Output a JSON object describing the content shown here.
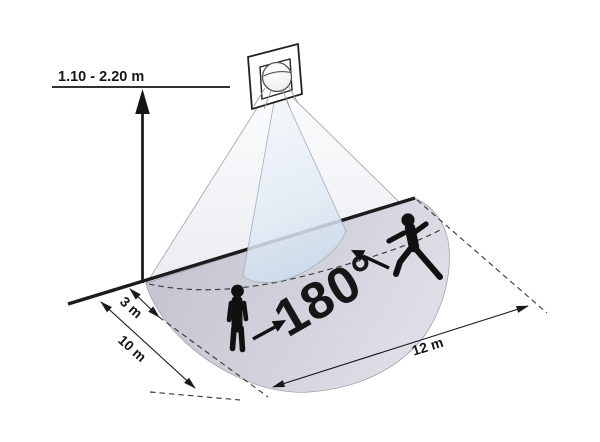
{
  "labels": {
    "mounting_height": "1.10 - 2.20 m",
    "coverage_angle": "180°",
    "dim_3m": "3 m",
    "dim_10m": "10 m",
    "dim_12m": "12 m"
  },
  "colors": {
    "ink": "#1c1c1c",
    "silhouette": "#111111",
    "floor_left": "#c3c4cf",
    "floor_right": "#dcdde5",
    "cone_outer": "#eceef2",
    "cone_inner": "#d7e3f1",
    "background": "#ffffff"
  },
  "icons": {
    "sensor-icon": "wall plate with spherical lens",
    "walking-person-icon": "black walking silhouette",
    "standing-person-icon": "black standing silhouette",
    "up-arrow-icon": "height dimension arrow",
    "direction-arrow-icon": "bold motion-direction arrow"
  }
}
